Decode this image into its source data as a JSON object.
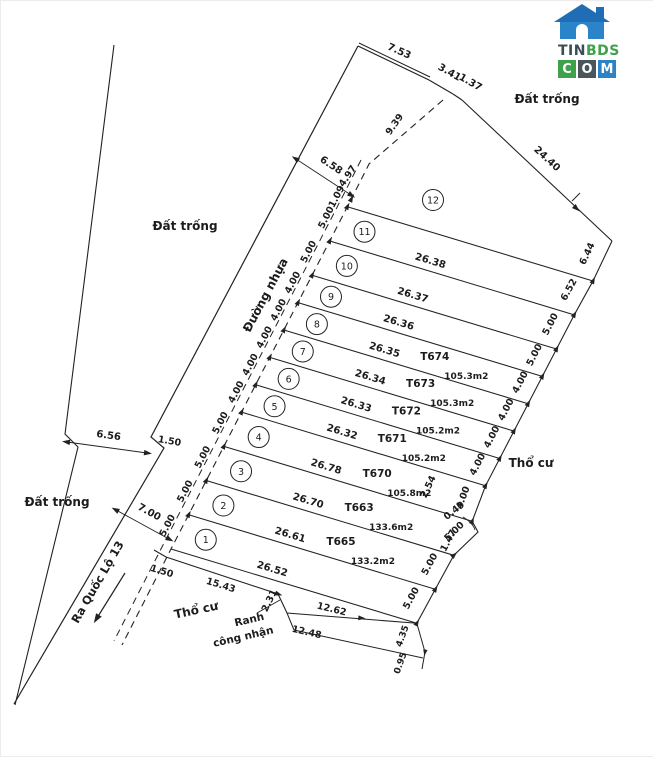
{
  "logo": {
    "tin": "TIN",
    "bds": "BDS",
    "com": [
      "C",
      "O",
      "M"
    ],
    "colors": {
      "house_roof": "#1f6db4",
      "house_body": "#2b83c9",
      "tin": "#3c4e55",
      "bds": "#3fa24b",
      "tile_c": "#3fa24b",
      "tile_o": "#4a555c",
      "tile_m": "#2d81c5"
    }
  },
  "regions": {
    "dat_trong_top": "Đất trống",
    "dat_trong_left": "Đất trống",
    "dat_trong_bottom": "Đất trống",
    "tho_cu_right": "Thổ cư",
    "tho_cu_bottom": "Thổ cư",
    "duong_nhua": "Đường nhựa",
    "ra_quoc_lo": "Ra Quốc Lộ 13",
    "ranh_line1": "Ranh",
    "ranh_line2": "công nhận"
  },
  "top_edge": [
    "7.53",
    "3.41",
    "1.37"
  ],
  "right_top": "24.40",
  "road": {
    "width_top": "6.58",
    "width_bottom": "6.56",
    "step": "1.50",
    "width_lower": "7.00",
    "bend_seg": "4.97",
    "bend_small": "1.09",
    "dashed_len": "9.39"
  },
  "bottom_edge": {
    "seg1": "1.50",
    "seg2": "15.43",
    "jog": "2.31",
    "seg3": "12.62",
    "lower_line": "12.48",
    "corner1": "4.35",
    "corner2": "0.95"
  },
  "right_jog": [
    "2.54",
    "0.49",
    "1.47"
  ],
  "plots": [
    {
      "num": "1",
      "line": "26.52",
      "front": "5.00",
      "back": "5.00"
    },
    {
      "num": "2",
      "line": "26.61",
      "id": "T665",
      "area": "133.2m2",
      "front": "5.00",
      "back": "5.00"
    },
    {
      "num": "3",
      "line": "26.70",
      "id": "T663",
      "area": "133.6m2",
      "front": "5.00",
      "back": "5.00"
    },
    {
      "num": "4",
      "line": "26.78",
      "id": "T670",
      "area": "105.8m2",
      "front": "5.00",
      "back": "4.00"
    },
    {
      "num": "5",
      "line": "26.32",
      "id": "T671",
      "area": "105.2m2",
      "front": "4.00",
      "back": "4.00"
    },
    {
      "num": "6",
      "line": "26.33",
      "id": "T672",
      "area": "105.2m2",
      "front": "4.00",
      "back": "4.00"
    },
    {
      "num": "7",
      "line": "26.34",
      "id": "T673",
      "area": "105.3m2",
      "front": "4.00",
      "back": "4.00"
    },
    {
      "num": "8",
      "line": "26.35",
      "id": "T674",
      "area": "105.3m2",
      "front": "4.00",
      "back": "4.00"
    },
    {
      "num": "9",
      "line": "26.36",
      "front": "4.00",
      "back": "5.00"
    },
    {
      "num": "10",
      "line": "26.37",
      "front": "5.00",
      "back": "5.00"
    },
    {
      "num": "11",
      "line": "26.38",
      "front": "5.00",
      "back": "6.52"
    },
    {
      "num": "12",
      "back": "6.44"
    }
  ]
}
